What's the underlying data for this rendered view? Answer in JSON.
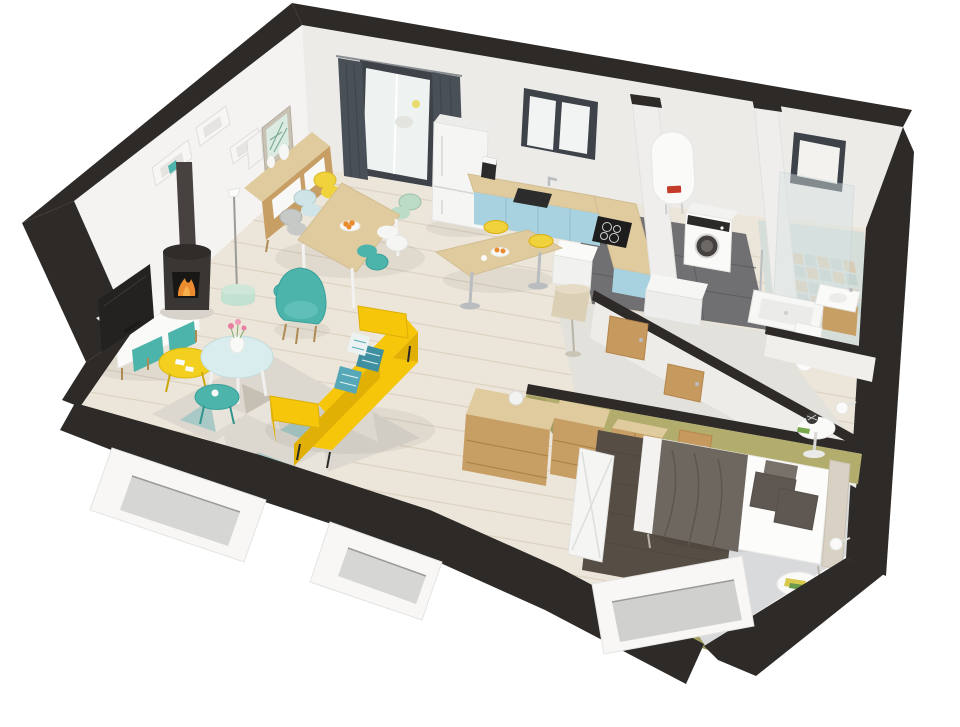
{
  "scene": {
    "kind": "isometric-3d-floor-plan-cutaway",
    "background": "#ffffff",
    "rooms": [
      {
        "name": "living-room",
        "floor": "light-wood-planks"
      },
      {
        "name": "dining-area",
        "floor": "light-wood-planks"
      },
      {
        "name": "kitchen",
        "floor": "light-wood-planks"
      },
      {
        "name": "hallway",
        "floor": "pale-gray"
      },
      {
        "name": "laundry-room",
        "floor": "dark-gray-tile"
      },
      {
        "name": "bathroom",
        "floor": "patterned-cement-tile"
      },
      {
        "name": "bedroom",
        "floor": "pale-gray",
        "walls": "olive-green"
      }
    ],
    "furniture": {
      "living-room": [
        "tv-stand",
        "tv",
        "wood-stove",
        "stove-pipe",
        "wall-cube-shelves",
        "framed-botanical-art",
        "sideboard",
        "floor-lamp-mint-base",
        "teal-armchair",
        "yellow-sofa",
        "patterned-cushions",
        "nesting-coffee-tables",
        "flower-vase",
        "geometric-rug"
      ],
      "dining-area": [
        "dining-table",
        "six-scandinavian-chairs",
        "fruit-bowl"
      ],
      "kitchen": [
        "fridge",
        "blue-base-cabinets",
        "wood-countertop",
        "sink",
        "induction-hob",
        "appliance-cube",
        "kettle",
        "window",
        "glass-patio-door",
        "dark-curtains",
        "bar-table",
        "yellow-bar-stools"
      ],
      "laundry-room": [
        "water-heater",
        "washing-machine",
        "storage-chest"
      ],
      "bathroom": [
        "small-window",
        "glass-shower-panel",
        "shower-tray",
        "towel-rail",
        "vanity-sink",
        "toilet"
      ],
      "hallway": [
        "beige-floor-lamp",
        "wood-doors"
      ],
      "bedroom": [
        "double-bed",
        "gray-blanket",
        "gray-pillows",
        "headboard",
        "brown-shag-rug",
        "round-nightstands",
        "wall-sconces",
        "wardrobe",
        "chest-of-drawers",
        "console-desk",
        "folding-screen",
        "window-cutout"
      ]
    },
    "structure": [
      "black-roof-edge-band",
      "white-cut-walls",
      "window-cutouts"
    ]
  },
  "colors": {
    "background": "#ffffff",
    "wall_white": "#f4f3f1",
    "wall_shade": "#ecebe8",
    "wall_cut": "#2d2a28",
    "plaster_cut": "#f8f7f5",
    "opening_shadow": "#d6d6d4",
    "olive_wall": "#b2ac6d",
    "olive_wall_dark": "#a39d61",
    "wood_floor": "#ece5d9",
    "plank_line": "#ddd3c2",
    "hall_floor": "#e3e1dc",
    "bedroom_floor": "#d9dadc",
    "laundry_tile": "#707072",
    "laundry_grout": "#5d5d5f",
    "bath_tile": "#d6ded9",
    "bath_tile_blue": "#c3d2cd",
    "bath_tile_tan": "#dbc9ad",
    "wood_light": "#e0cb9e",
    "wood_mid": "#c79e63",
    "wood_leg": "#b08a55",
    "white_furniture": "#fafaf9",
    "teal": "#4db4ac",
    "teal_deep": "#3aa39b",
    "mint": "#c2e1d0",
    "pale_blue": "#d9edee",
    "cabinet_blue": "#a8d2e0",
    "sofa_yellow": "#f6c60a",
    "sofa_yellow_deep": "#e0b007",
    "chair_yellow": "#f0d23c",
    "chair_gray": "#c7c9c6",
    "chair_white": "#f5f5f3",
    "chair_blue": "#cfe4e6",
    "chair_mint": "#bcdcc8",
    "curtain": "#4a5057",
    "window_frame": "#3d4349",
    "tv_black": "#232220",
    "stove_black": "#3a3634",
    "flame_orange": "#ea8c2f",
    "rug_base": "#ddd8cf",
    "rug_teal": "#a9c9c6",
    "rug_taupe": "#c6bfb4",
    "rug_cream": "#e9e4db",
    "bed_white": "#fcfcfb",
    "blanket_taupe": "#6e6760",
    "pillow_taupe": "#5f5852",
    "bed_rug_brown": "#564d44",
    "headboard_beige": "#d9d2c4",
    "appliance_white": "#f5f5f4",
    "glass_blue": "#d8e3e5",
    "chrome": "#b9bdbf",
    "door_wood": "#c69a5f",
    "lamp_beige": "#dbcfb5",
    "heater_label_red": "#c43b2a",
    "fruit_orange": "#e98a2d",
    "flower_pink": "#e87fa0"
  }
}
